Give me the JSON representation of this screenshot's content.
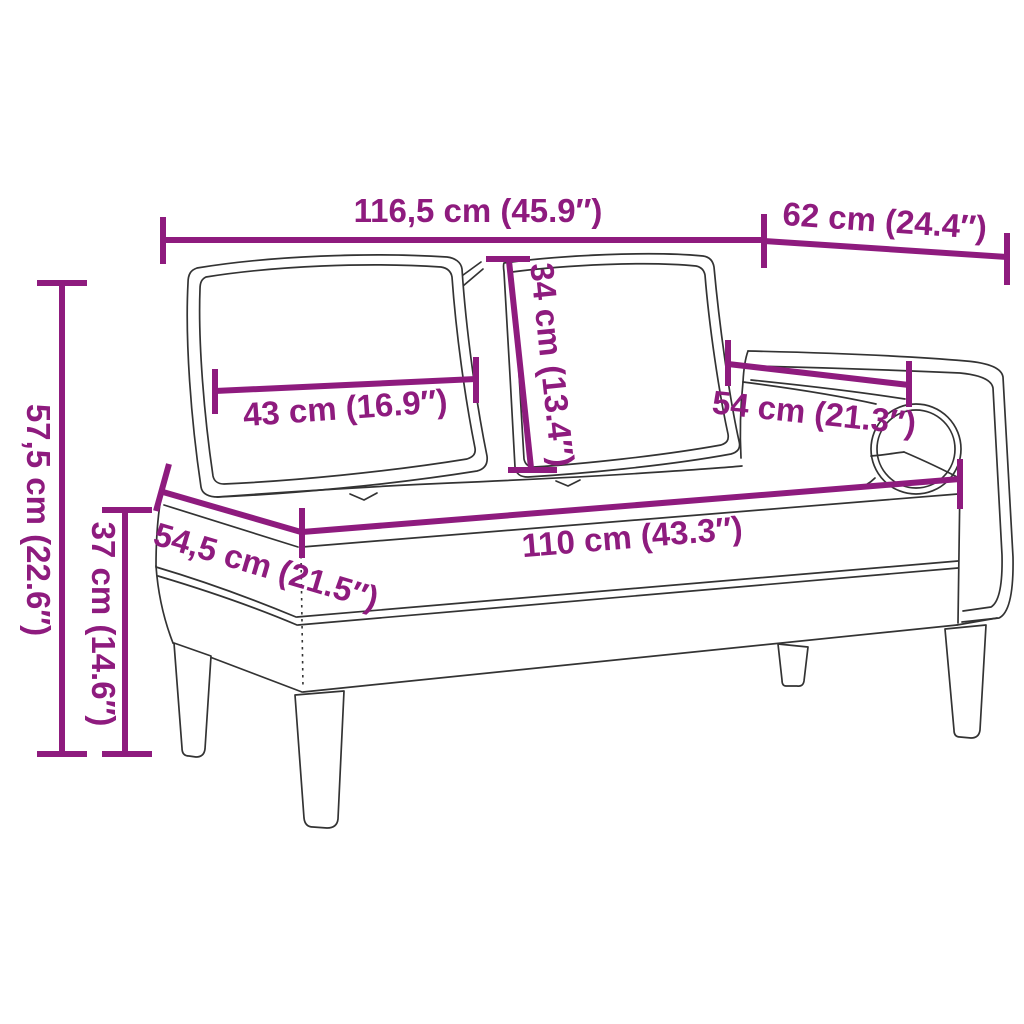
{
  "colors": {
    "accent": "#8e1b7e",
    "line_art": "#333333",
    "background": "#ffffff"
  },
  "diagram": {
    "type": "furniture-dimension-diagram",
    "subject": "chaise longue with back cushions and bolster",
    "measurements": {
      "overall_width": {
        "label": "116,5 cm (45.9″)"
      },
      "arm_section_depth": {
        "label": "62 cm (24.4″)"
      },
      "overall_height": {
        "label": "57,5 cm (22.6″)"
      },
      "seat_height": {
        "label": "37 cm (14.6″)"
      },
      "back_cushion_width": {
        "label": "43 cm (16.9″)"
      },
      "back_cushion_height": {
        "label": "34 cm (13.4″)"
      },
      "armrest_length": {
        "label": "54 cm (21.3″)"
      },
      "seat_length": {
        "label": "110 cm (43.3″)"
      },
      "seat_depth": {
        "label": "54,5 cm (21.5″)"
      }
    }
  }
}
